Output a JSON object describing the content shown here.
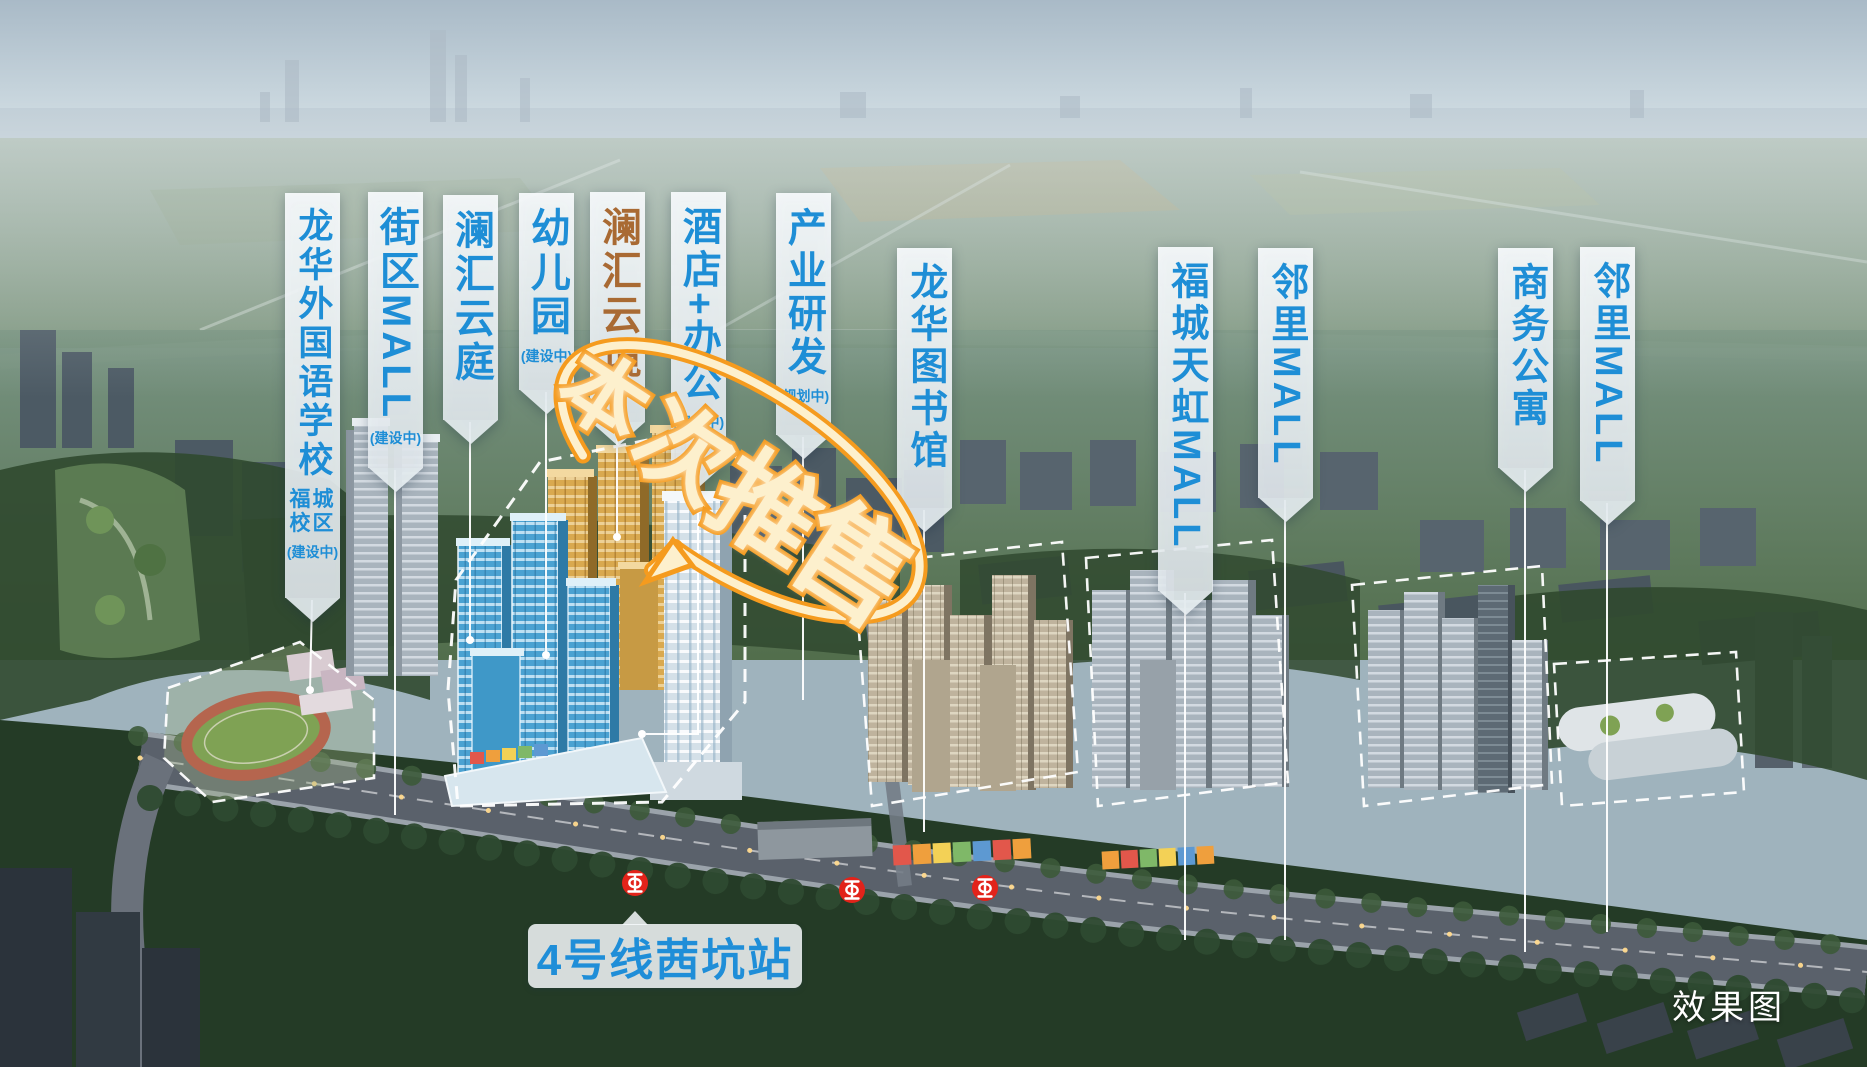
{
  "watermark": "效果图",
  "station": {
    "label": "4号线茜坑站"
  },
  "promo_badge": {
    "text": "本次推售",
    "chars": [
      "本",
      "次",
      "推",
      "售"
    ]
  },
  "metro_icons": {
    "name": "shenzhen-metro-logo",
    "count": 3,
    "color": "#e2231a"
  },
  "banners": [
    {
      "title": "龙华外国语学校",
      "subtitle": "福城校区",
      "status": "(建设中)"
    },
    {
      "title": "街区MALL",
      "status": "(建设中)"
    },
    {
      "title": "澜汇云庭"
    },
    {
      "title": "幼儿园",
      "status": "(建设中)"
    },
    {
      "title": "澜汇云境",
      "highlight": true
    },
    {
      "title": "酒店+办公",
      "status": "(建设中)"
    },
    {
      "title": "产业研发",
      "status": "(规划中)"
    },
    {
      "title": "龙华图书馆"
    },
    {
      "title": "福城天虹MALL"
    },
    {
      "title": "邻里MALL"
    },
    {
      "title": "商务公寓"
    },
    {
      "title": "邻里MALL"
    }
  ],
  "colors": {
    "label_text": "#1e8ed6",
    "label_highlight": "#a96a33",
    "badge_fill": "#fdf0cd",
    "badge_outline": "#f59b1e",
    "metro_red": "#e2231a",
    "station_text": "#1f8ed8"
  }
}
